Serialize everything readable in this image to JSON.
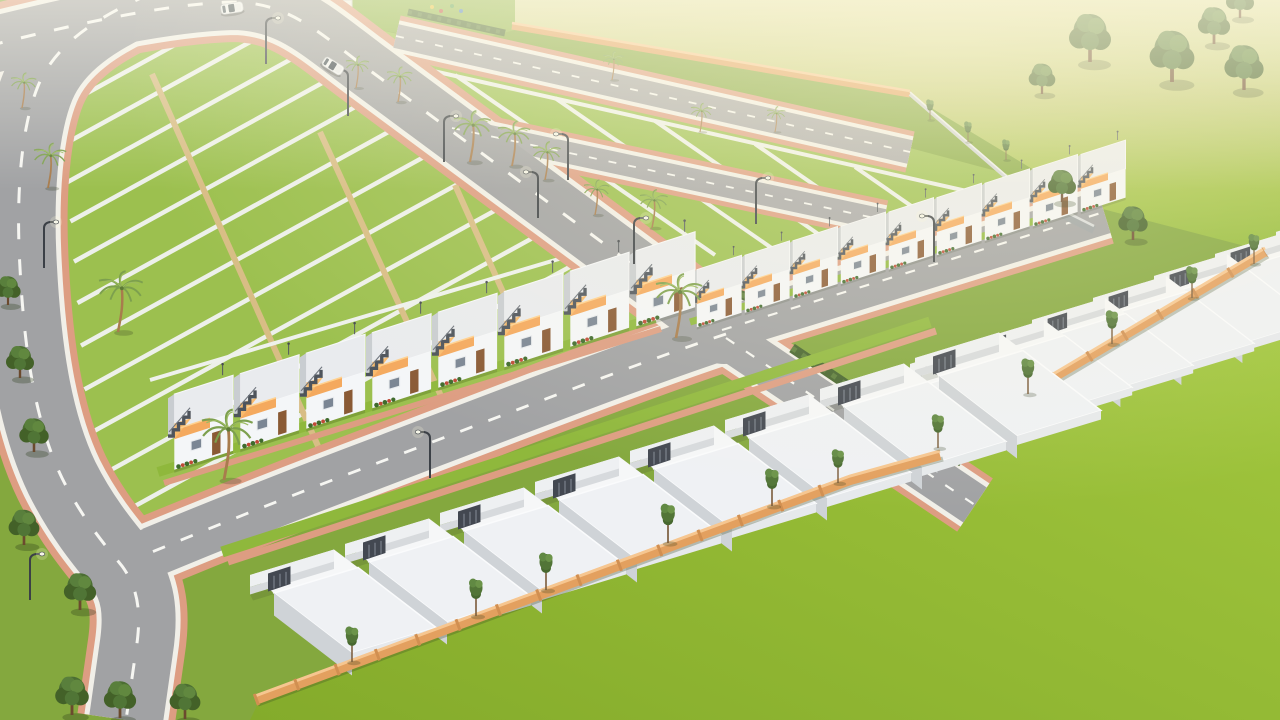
{
  "meta": {
    "render_type": "3d-aerial-architectural-render",
    "subject": "gated residential plotted development with row houses under a hazy warm sky light",
    "view": "high-angle isometric aerial view",
    "visible_text": "none"
  },
  "palette": {
    "grass_base": "#84a83e",
    "plot_grass": "#9cc04f",
    "lawn_bright": "#93b831",
    "field_pale": "#cfd287",
    "plot_divider": "#edf0ea",
    "plot_path_sand": "#d8bd85",
    "road": "#a1a2a4",
    "road_minor": "#a8a8aa",
    "road_marking": "#f6f6f2",
    "sidewalk": "#dd9d82",
    "curb": "#f1efe8",
    "house_white": "#f4f6f8",
    "roof_slab": "#e9ebee",
    "wall_shade": "#c9cdd1",
    "canopy_orange": "#f4a95e",
    "stair_gray": "#4e545c",
    "door_brown": "#8a5a35",
    "boundary_wall": "#e3a05f",
    "boundary_wall_top": "#f6c690",
    "hedge_green": "#44632c",
    "tree_green": "#4c6e33",
    "palm_frond": "#7da04e",
    "palm_trunk": "#a87c4d",
    "car_white": "#f3f4f5",
    "pool_blue": "#7fb5c9"
  },
  "scene": {
    "plot_grids": [
      {
        "name": "left strip plots",
        "strips": 12,
        "cross_paths": 3
      },
      {
        "name": "upper square plots",
        "plots": 10
      }
    ],
    "house_blocks": [
      {
        "name": "finished row houses center-left",
        "units": 8,
        "style": "white townhouses, orange canopy, rooftop side stair"
      },
      {
        "name": "finished row houses upper-center",
        "units": 9,
        "style": "white townhouses, orange canopy, rooftop side stair"
      },
      {
        "name": "shell units right compound",
        "units": 8,
        "style": "under-construction boxes, flat white roofs, front yards with gates"
      },
      {
        "name": "shell units bottom compound",
        "units": 8,
        "style": "under-construction boxes, flat white roofs, front yards with gates"
      }
    ],
    "roads": [
      "left perimeter road",
      "main diagonal avenue",
      "lower cross road",
      "right cross road",
      "south-east access road",
      "upper service road",
      "inner plot road"
    ],
    "junctions": [
      "four-way junction at center",
      "curved corner at lower-left"
    ],
    "vegetation": {
      "palm_trees": 15,
      "round_trees": 16,
      "slender_trees": 14,
      "hedges": 4
    },
    "street_lights": 11,
    "vehicles": {
      "white_cars": 2
    },
    "amenities": {
      "clubhouse_building": 1,
      "playground": 1,
      "plunge_pool": 1
    },
    "boundary_walls": {
      "orange_compound_walls": 3,
      "gray_walls": 2
    }
  }
}
